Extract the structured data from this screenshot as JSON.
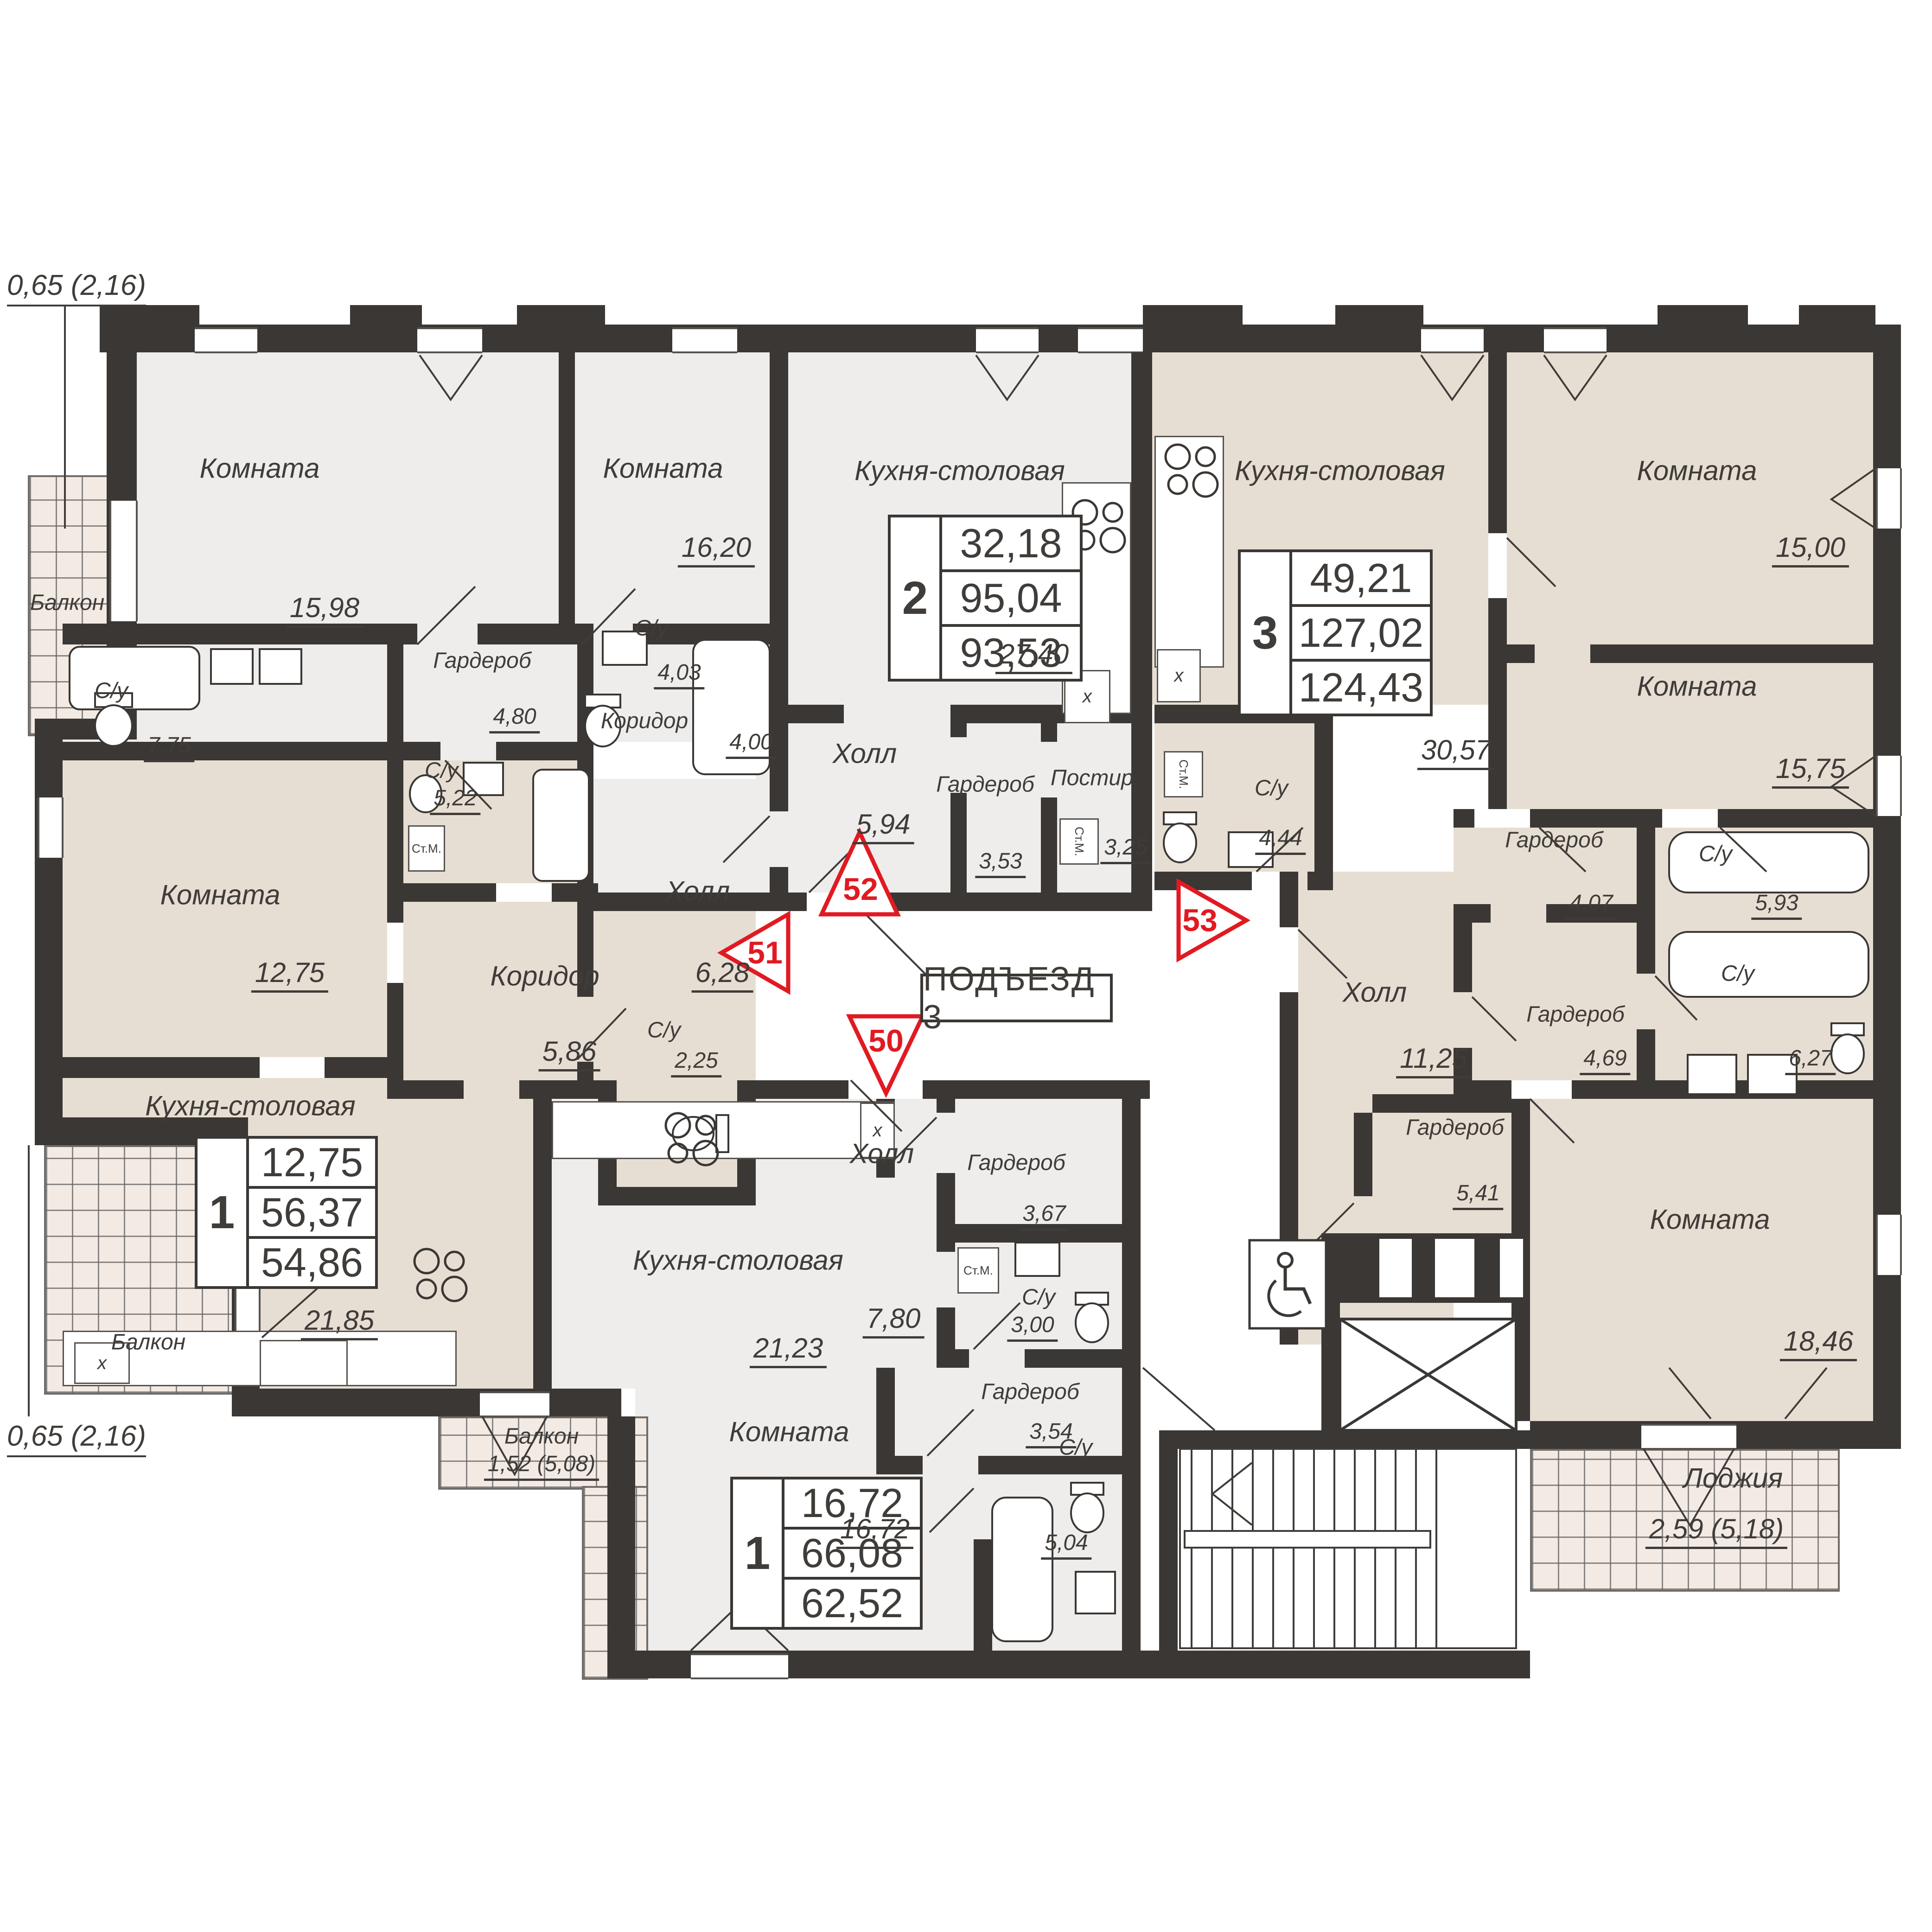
{
  "dimensions": {
    "top_left": "0,65 (2,16)",
    "bottom_left": "0,65 (2,16)"
  },
  "entrance": {
    "label": "ПОДЪЕЗД 3"
  },
  "markers": [
    {
      "number": "50"
    },
    {
      "number": "51"
    },
    {
      "number": "52"
    },
    {
      "number": "53"
    }
  ],
  "apartments": [
    {
      "rooms_count": "2",
      "living_area": "32,18",
      "total_area": "95,04",
      "reduced_area": "93,53"
    },
    {
      "rooms_count": "3",
      "living_area": "49,21",
      "total_area": "127,02",
      "reduced_area": "124,43"
    },
    {
      "rooms_count": "1",
      "living_area": "12,75",
      "total_area": "56,37",
      "reduced_area": "54,86"
    },
    {
      "rooms_count": "1",
      "living_area": "16,72",
      "total_area": "66,08",
      "reduced_area": "62,52"
    }
  ],
  "rooms": [
    {
      "name": "Балкон",
      "area": ""
    },
    {
      "name": "Комната",
      "area": "15,98"
    },
    {
      "name": "Комната",
      "area": "16,20"
    },
    {
      "name": "Гардероб",
      "area": "4,80"
    },
    {
      "name": "С/у",
      "area": "4,03"
    },
    {
      "name": "Коридор",
      "area": "4,00"
    },
    {
      "name": "С/у",
      "area": "7,75"
    },
    {
      "name": "Кухня-столовая",
      "area": "27,40"
    },
    {
      "name": "Холл",
      "area": "5,94"
    },
    {
      "name": "Гардероб",
      "area": "3,53"
    },
    {
      "name": "Постир.",
      "area": "3,25"
    },
    {
      "name": "Кухня-столовая",
      "area": "30,57"
    },
    {
      "name": "С/у",
      "area": "4,44"
    },
    {
      "name": "Комната",
      "area": "15,00"
    },
    {
      "name": "Комната",
      "area": "15,75"
    },
    {
      "name": "Гардероб",
      "area": "4,07"
    },
    {
      "name": "С/у",
      "area": "5,93"
    },
    {
      "name": "Комната",
      "area": "12,75"
    },
    {
      "name": "С/у",
      "area": "5,22"
    },
    {
      "name": "Холл",
      "area": "6,28"
    },
    {
      "name": "Коридор",
      "area": "5,86"
    },
    {
      "name": "С/у",
      "area": "2,25"
    },
    {
      "name": "Кухня-столовая",
      "area": "21,85"
    },
    {
      "name": "Балкон",
      "area": ""
    },
    {
      "name": "Холл",
      "area": "11,25"
    },
    {
      "name": "Гардероб",
      "area": "4,69"
    },
    {
      "name": "С/у",
      "area": "6,27"
    },
    {
      "name": "Гардероб",
      "area": "5,41"
    },
    {
      "name": "Комната",
      "area": "18,46"
    },
    {
      "name": "Лоджия",
      "area": "2,59 (5,18)"
    },
    {
      "name": "Кухня-столовая",
      "area": "21,23"
    },
    {
      "name": "Холл",
      "area": "7,80"
    },
    {
      "name": "Гардероб",
      "area": "3,67"
    },
    {
      "name": "С/у",
      "area": "3,00"
    },
    {
      "name": "Гардероб",
      "area": "3,54"
    },
    {
      "name": "Комната",
      "area": "16,72"
    },
    {
      "name": "С/у",
      "area": "5,04"
    },
    {
      "name": "Балкон",
      "area": "1,52 (5,08)"
    }
  ],
  "fixtures": {
    "washing_machine": "Ст.М.",
    "fridge": "х"
  },
  "colors": {
    "wall": "#3a3734",
    "apartment_light": "#efedeb",
    "apartment_beige": "#e7ded3",
    "balcony": "#f3eae4",
    "marker_red": "#e11a22"
  }
}
